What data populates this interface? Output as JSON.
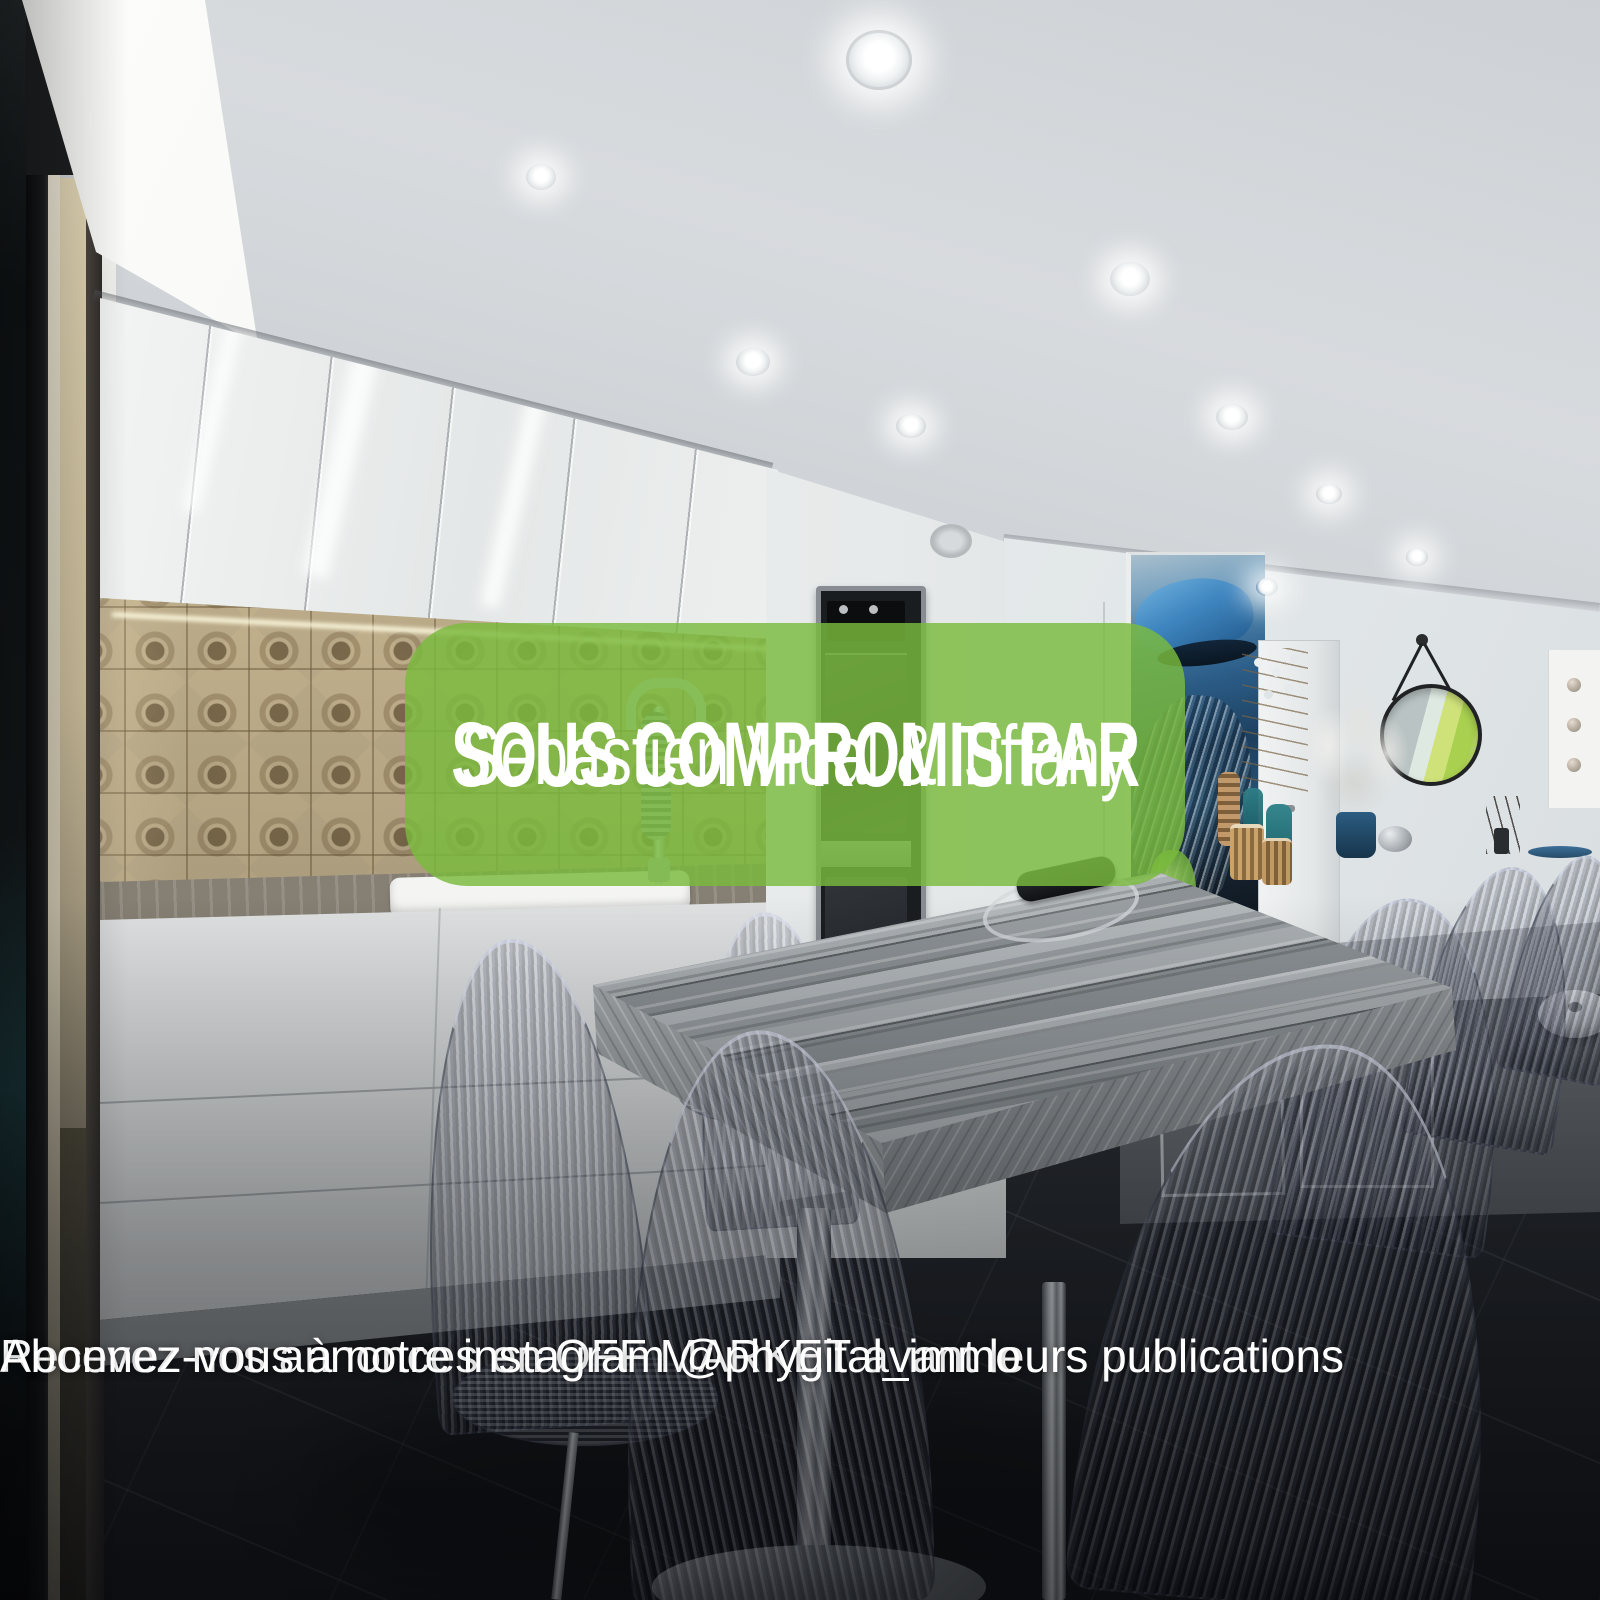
{
  "banner": {
    "title": "SOUS COMPROMIS PAR",
    "subtitle": "Sebastien Vidal & Tiffany",
    "background_color": "#7abb3d",
    "text_color": "#ffffff"
  },
  "footer": {
    "line1": "Recevez nos annonces en OFF MARKET avant leurs publications",
    "line2": "Abonnez-vous à notre instagram @phygital_immo",
    "text_color": "#ffffff"
  }
}
